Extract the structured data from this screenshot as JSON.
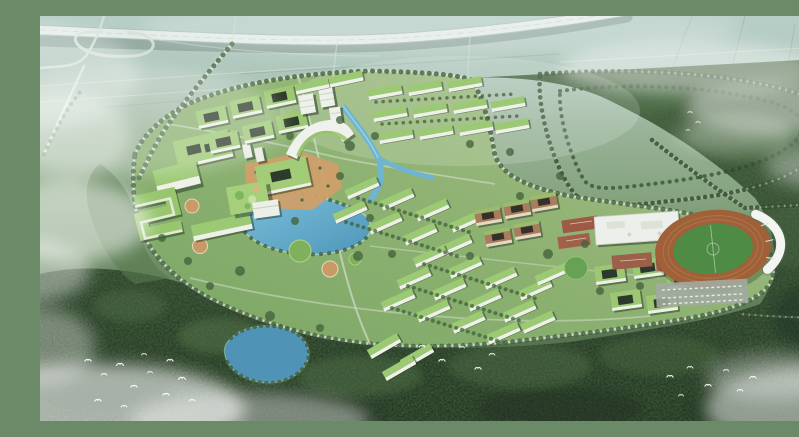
{
  "meta": {
    "type": "aerial architectural rendering",
    "subject": "Bird's-eye master-plan rendering of a green campus carved out of dense forest: elevated expressway with cloverleaf interchange at top left, hazy farmland above, tree-lined ring and loop roads, central lake and canal, green-roofed academic and dormitory blocks, a curved landmark building, white gymnasium, red sports courts, an oval stadium with white grandstand canopy, a forest pond, drifting mist and flocks of white birds"
  },
  "palette": {
    "haze_top": "#b7cec7",
    "field_green": "#9db8a4",
    "campus_green_light": "#a9c28a",
    "campus_green": "#7ba765",
    "forest_top": "#4a6844",
    "forest_dark": "#2c4229",
    "forest_deep": "#223521",
    "water_light": "#7cc2dc",
    "water_deep": "#4f95b8",
    "road_light": "#dde6de",
    "highway_deck": "#e2ebe7",
    "roof_green": "#9cc973",
    "facade_white": "#eef1e8",
    "plaza_tan": "#cf9f6a",
    "brick_brown": "#a87c5c",
    "track_brown": "#a06038",
    "pitch_green": "#4e8c46",
    "court_red": "#9d5a45",
    "canopy_white": "#f3f5f0",
    "tree_dark": "#3a5a34",
    "cloud_white": "#ffffff"
  },
  "features": {
    "scene": "Campus master plan aerial rendering",
    "highway": "Elevated expressway",
    "interchange": "Cloverleaf interchange ramps",
    "farmland": "Hazy farmland plots",
    "forest": "Dense forest belt",
    "loop_road": "Tree-lined loop roads in forest",
    "campus": "Campus grounds",
    "ring_road": "Tree-lined campus ring road",
    "avenue": "Tree-lined approach avenue",
    "central_lake": "Central campus lake",
    "south_lake": "Forest pond",
    "canal": "Campus canal",
    "plaza": "Central paved plaza",
    "arc_building": "Curved landmark building",
    "west_complex": "West academic complex with green roofs",
    "north_courtyards": "Courtyard academic blocks",
    "high_rises": "White high-rise slabs",
    "dormitories": "Green-roofed dormitory rows",
    "brick_cluster": "Brick courtyard cluster",
    "southeast_cluster": "Southeast residential cluster",
    "gymnasium": "White gymnasium hall",
    "courts": "Outdoor sports courts",
    "stadium": "Stadium with oval running track",
    "parking": "Parking lots",
    "clouds": "Low clouds and mist",
    "birds": "Flocks of white birds"
  }
}
